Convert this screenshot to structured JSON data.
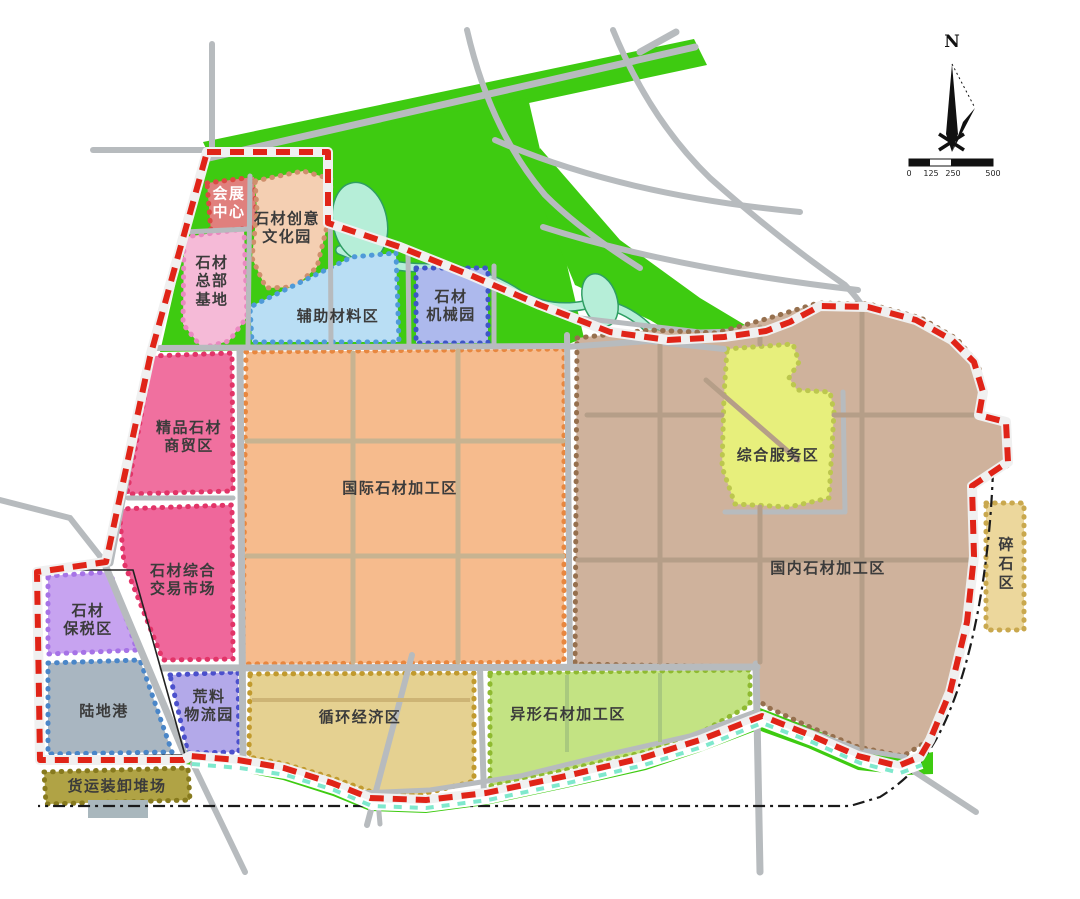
{
  "map": {
    "compass_label": "N",
    "scale_bar": {
      "ticks": [
        "0",
        "125",
        "250",
        "500"
      ]
    },
    "colors": {
      "green_belt": "#3ecb11",
      "water_fill": "#b6eed8",
      "water_edge": "#2f9e63",
      "road": "#b7bbbe",
      "road_tan": "#c7b391",
      "brown_grid": "#b59e88",
      "light_green_grid": "#a9c97e",
      "khaki_grid": "#cdb475",
      "boundary": "#e02418",
      "boundary_teal": "#7fe8cd",
      "railway": "#1a1a1a",
      "block_outline": "#222222",
      "building": "#a9b7bd",
      "ink": "#111111"
    },
    "zones": [
      {
        "id": "huizhan-center",
        "label": "会展\n中心",
        "fill": "#e0807d",
        "border": "#db4a43"
      },
      {
        "id": "chuangyi-park",
        "label": "石材创意\n文化园",
        "fill": "#f4cfb2",
        "border": "#cf8f6c"
      },
      {
        "id": "zongbu-base",
        "label": "石材\n总部\n基地",
        "fill": "#f5bad7",
        "border": "#e989c0"
      },
      {
        "id": "fuzhu-materials",
        "label": "辅助材料区",
        "fill": "#b9def4",
        "border": "#4f9ad8"
      },
      {
        "id": "jixie-park",
        "label": "石材\n机械园",
        "fill": "#adb9ed",
        "border": "#3d56c6"
      },
      {
        "id": "jingpin-trade",
        "label": "精品石材\n商贸区",
        "fill": "#f0709f",
        "border": "#e23468"
      },
      {
        "id": "intl-processing",
        "label": "国际石材加工区",
        "fill": "#f6bb8d",
        "border": "#e8873f"
      },
      {
        "id": "domestic-processing",
        "label": "国内石材加工区",
        "fill": "#cfb29c",
        "border": "#96704e"
      },
      {
        "id": "service-zone",
        "label": "综合服务区",
        "fill": "#e7ef7c",
        "border": "#bcc74e"
      },
      {
        "id": "suishi-zone",
        "label": "碎石区",
        "fill": "#ecd79c",
        "border": "#c9a84e"
      },
      {
        "id": "trading-market",
        "label": "石材综合\n交易市场",
        "fill": "#ef679b",
        "border": "#e23468"
      },
      {
        "id": "baoshui-zone",
        "label": "石材\n保税区",
        "fill": "#c7a3f0",
        "border": "#a673e6"
      },
      {
        "id": "ludi-port",
        "label": "陆地港",
        "fill": "#a9b6c1",
        "border": "#4a86c8"
      },
      {
        "id": "huangliao-logistics",
        "label": "荒料\n物流园",
        "fill": "#b3a9e9",
        "border": "#4b50cc"
      },
      {
        "id": "xunhuan-economy",
        "label": "循环经济区",
        "fill": "#e5d191",
        "border": "#c19a2e"
      },
      {
        "id": "yixing-processing",
        "label": "异形石材加工区",
        "fill": "#c3e383",
        "border": "#8fba31"
      },
      {
        "id": "freight-yard",
        "label": "货运装卸堆场",
        "fill": "#b0a345",
        "border": "#877a1e"
      }
    ]
  }
}
